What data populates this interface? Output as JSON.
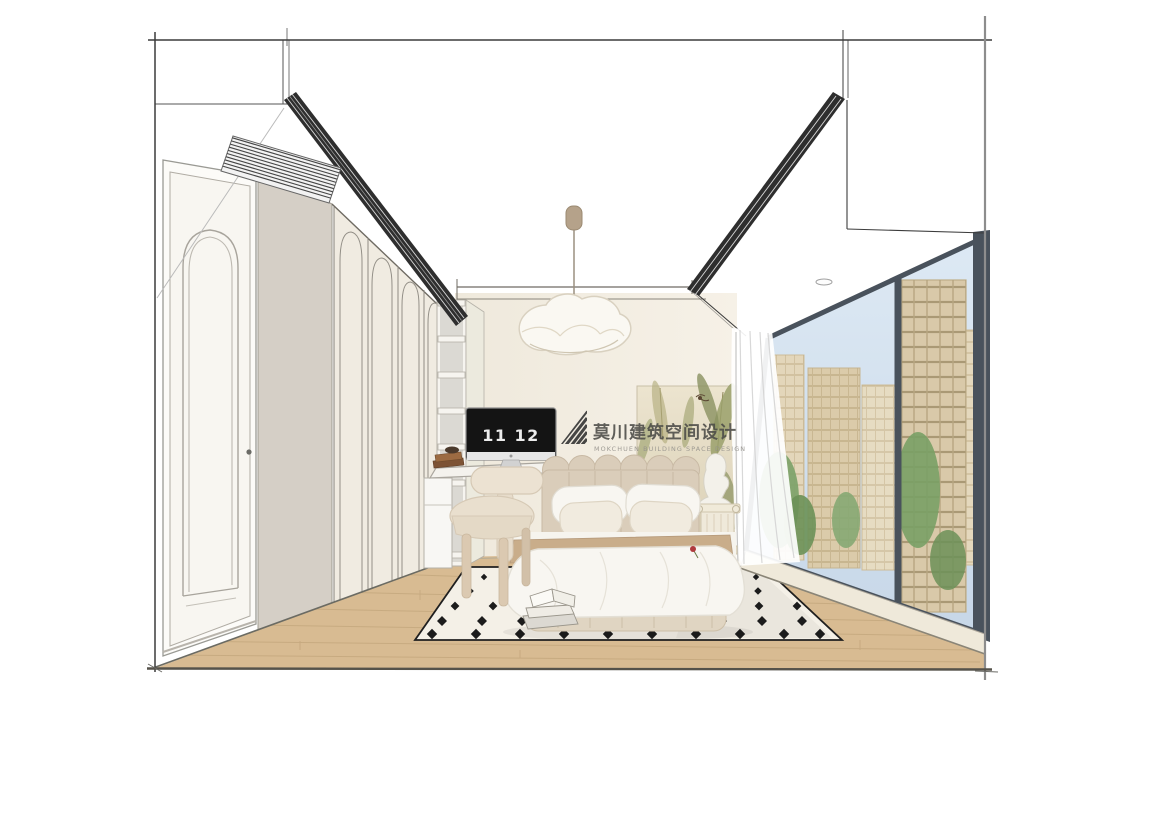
{
  "title": "bedroom-interior-sketch-rendering",
  "watermark": {
    "logo": "mokchuen-stripes-logo",
    "cn": "莫川建筑空间设计",
    "en": "MOKCHUEN BUILDING SPACE DESIGN"
  },
  "computer": {
    "clock": "11 12"
  },
  "palette": {
    "background": "#ffffff",
    "wall": "#f4efe5",
    "side_wall": "#d5cfc6",
    "wood_floor": "#d8bb92",
    "rug": "#f4f0e7",
    "rug_motif": "#1c1c1c",
    "headboard": "#dacdba",
    "bedding": "#f8f6f1",
    "throw": "#c9ad8a",
    "boucle_chair": "#ece2d2",
    "window_frame": "#49525c",
    "sky": "#d6e3f0",
    "building": "#d9c9a9",
    "foliage": "#86a873",
    "sketch_line": "#3c3c3c"
  },
  "objects": [
    "arched-door",
    "arched-wardrobe",
    "open-shelf-tower",
    "desk",
    "imac-computer",
    "boucle-chair",
    "cloud-pendant-light",
    "bed",
    "pillows",
    "throw-blanket",
    "diamond-rug",
    "books",
    "plaster-bust",
    "column-side-table",
    "botanical-mural",
    "sheer-curtain",
    "panoramic-window",
    "city-buildings",
    "trees",
    "linear-ac-grilles",
    "ceiling-vent",
    "downlight"
  ]
}
